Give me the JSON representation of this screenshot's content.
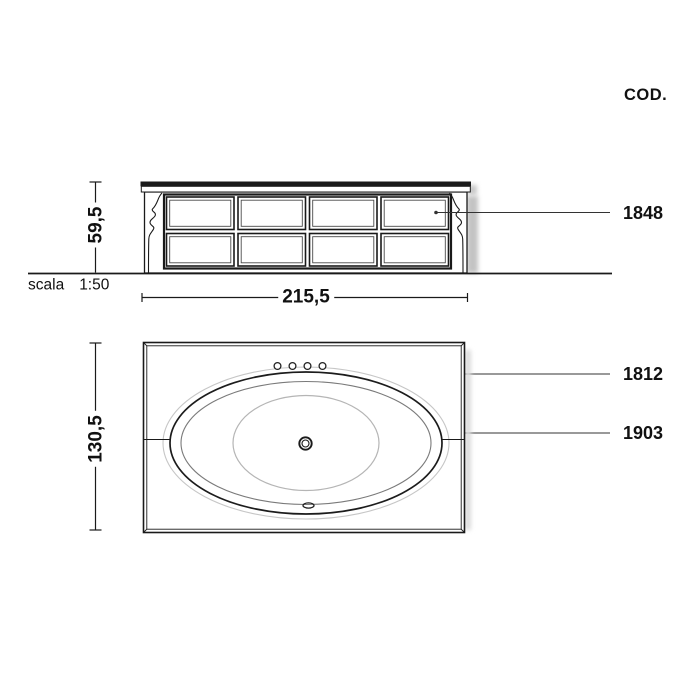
{
  "page": {
    "cod_label": "COD."
  },
  "scale": {
    "word": "scala",
    "ratio": "1:50"
  },
  "front_view": {
    "height_dim": "59,5",
    "width_dim": "215,5",
    "panel_rows": 2,
    "panel_cols": 4,
    "code_label": "1848"
  },
  "plan_view": {
    "depth_dim": "130,5",
    "deck_code_label": "1812",
    "tub_code_label": "1903",
    "faucet_holes": 4
  },
  "colors": {
    "ink": "#1a1a1a",
    "mid_line": "#7a7a7a",
    "light_line": "#c6c6c6",
    "shadow": "#c9c9c9",
    "background": "#ffffff"
  }
}
